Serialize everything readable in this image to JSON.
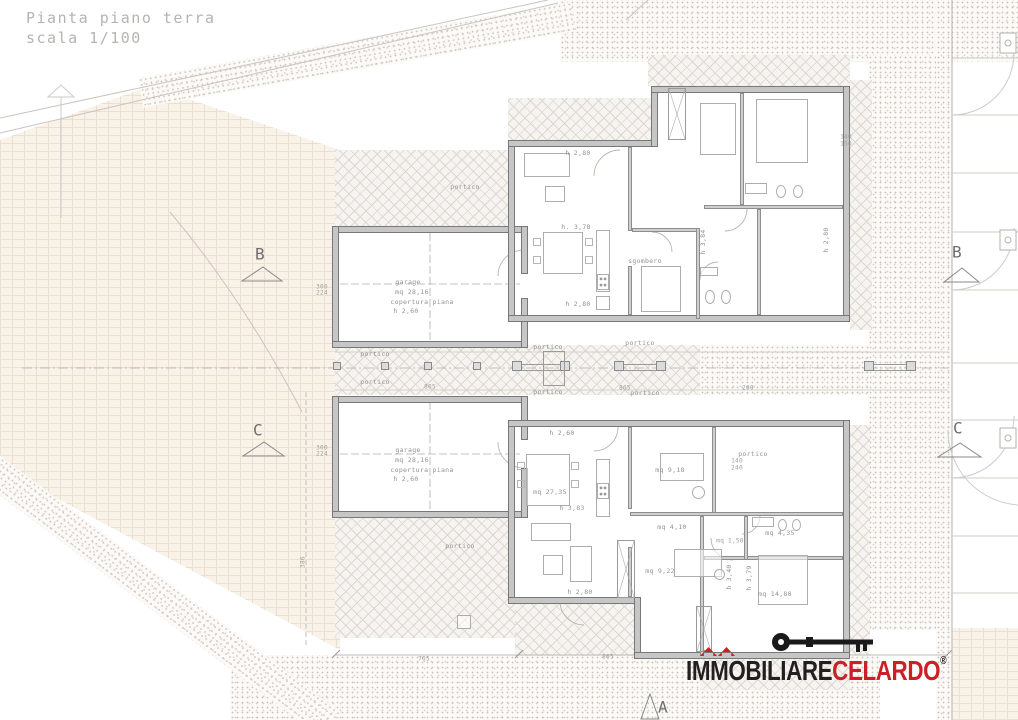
{
  "title": {
    "line1": "Pianta piano terra",
    "line2": "scala 1/100"
  },
  "logo": {
    "brand_black": "IMMOBILIARE",
    "brand_red": "CELARDO",
    "registered": "®",
    "color_black": "#231f20",
    "color_red": "#cb2026"
  },
  "labels": [
    {
      "t": "portico",
      "x": 465,
      "y": 187
    },
    {
      "t": "garage",
      "x": 408,
      "y": 282
    },
    {
      "t": "mq 28,16",
      "x": 412,
      "y": 292
    },
    {
      "t": "copertura piana",
      "x": 422,
      "y": 302
    },
    {
      "t": "h 2,60",
      "x": 406,
      "y": 311
    },
    {
      "t": "h 2,80",
      "x": 578,
      "y": 153
    },
    {
      "t": "h. 3,78",
      "x": 576,
      "y": 227
    },
    {
      "t": "sgombero",
      "x": 645,
      "y": 261
    },
    {
      "t": "h 2,80",
      "x": 578,
      "y": 304
    },
    {
      "t": "h 3,84",
      "x": 703,
      "y": 242,
      "r": -90
    },
    {
      "t": "h 2,80",
      "x": 826,
      "y": 240,
      "r": -90
    },
    {
      "t": "140",
      "x": 846,
      "y": 137,
      "c": "dim"
    },
    {
      "t": "150",
      "x": 846,
      "y": 144,
      "c": "dim"
    },
    {
      "t": "300",
      "x": 322,
      "y": 287,
      "c": "dim"
    },
    {
      "t": "224",
      "x": 322,
      "y": 293,
      "c": "dim"
    },
    {
      "t": "300",
      "x": 322,
      "y": 448,
      "c": "dim"
    },
    {
      "t": "224",
      "x": 322,
      "y": 454,
      "c": "dim"
    },
    {
      "t": "805",
      "x": 430,
      "y": 387,
      "c": "dim"
    },
    {
      "t": "805",
      "x": 625,
      "y": 388,
      "c": "dim"
    },
    {
      "t": "200",
      "x": 748,
      "y": 388,
      "c": "dim"
    },
    {
      "t": "portico",
      "x": 375,
      "y": 354
    },
    {
      "t": "portico",
      "x": 375,
      "y": 382
    },
    {
      "t": "portico",
      "x": 548,
      "y": 347
    },
    {
      "t": "portico",
      "x": 548,
      "y": 392
    },
    {
      "t": "portico",
      "x": 640,
      "y": 343
    },
    {
      "t": "portico",
      "x": 645,
      "y": 393
    },
    {
      "t": "portico",
      "x": 753,
      "y": 454
    },
    {
      "t": "portico",
      "x": 460,
      "y": 546
    },
    {
      "t": "garage",
      "x": 408,
      "y": 450
    },
    {
      "t": "mq 28,16",
      "x": 412,
      "y": 460
    },
    {
      "t": "copertura piana",
      "x": 422,
      "y": 470
    },
    {
      "t": "h 2,60",
      "x": 406,
      "y": 479
    },
    {
      "t": "h 2,60",
      "x": 562,
      "y": 433
    },
    {
      "t": "mq 27,35",
      "x": 550,
      "y": 492
    },
    {
      "t": "h 3,83",
      "x": 572,
      "y": 508
    },
    {
      "t": "mq 9,18",
      "x": 670,
      "y": 470
    },
    {
      "t": "mq 4,10",
      "x": 672,
      "y": 527
    },
    {
      "t": "mq 1,50",
      "x": 730,
      "y": 541,
      "c": "dim"
    },
    {
      "t": "mq 4,35",
      "x": 780,
      "y": 533
    },
    {
      "t": "mq 9,22",
      "x": 660,
      "y": 571
    },
    {
      "t": "mq 14,80",
      "x": 775,
      "y": 594
    },
    {
      "t": "h 2,80",
      "x": 580,
      "y": 592
    },
    {
      "t": "h 3,40",
      "x": 729,
      "y": 577,
      "r": -90
    },
    {
      "t": "h 3,79",
      "x": 749,
      "y": 578,
      "r": -90
    },
    {
      "t": "140",
      "x": 737,
      "y": 461,
      "c": "dim"
    },
    {
      "t": "240",
      "x": 737,
      "y": 468,
      "c": "dim"
    },
    {
      "t": "705",
      "x": 424,
      "y": 659,
      "c": "dim"
    },
    {
      "t": "865",
      "x": 608,
      "y": 657,
      "c": "dim"
    },
    {
      "t": "386",
      "x": 303,
      "y": 562,
      "r": -90,
      "c": "dim"
    },
    {
      "t": "B",
      "x": 260,
      "y": 254,
      "c": "big"
    },
    {
      "t": "C",
      "x": 258,
      "y": 430,
      "c": "big"
    },
    {
      "t": "B",
      "x": 957,
      "y": 252,
      "c": "big"
    },
    {
      "t": "C",
      "x": 958,
      "y": 428,
      "c": "big"
    },
    {
      "t": "A",
      "x": 663,
      "y": 707,
      "c": "big"
    }
  ]
}
